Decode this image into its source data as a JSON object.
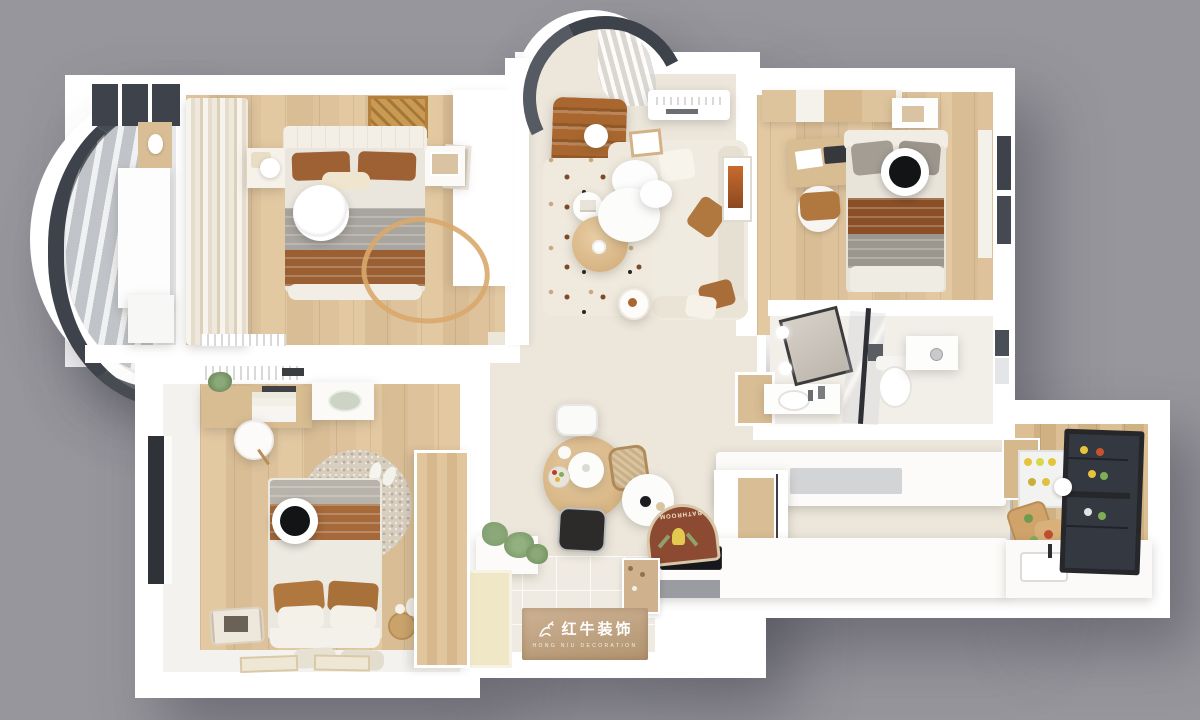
{
  "scene": {
    "description": "3D rendered top-down floor plan of a three-bedroom apartment on a gray backdrop",
    "rooms": [
      "curved-balcony-sunroom",
      "master-bedroom",
      "living-room",
      "bedroom-2",
      "bathroom",
      "hallway-dining",
      "kitchen",
      "bedroom-3",
      "entry-foyer"
    ]
  },
  "branding": {
    "logo_cn": "红牛装饰",
    "logo_en": "HONG NIU DECORATION"
  },
  "labels": {
    "bath_mat": "BATHROOM"
  },
  "colors": {
    "bg": "#97969c",
    "wall": "#ffffff",
    "cream": "#ece6db",
    "glass": "#3e434b",
    "leather": "#a9672f",
    "blanket-brown": "#9a5f33",
    "caramel": "#b0773f",
    "fabric-gray": "#a8a49e",
    "lamp-black": "#131416",
    "plant-green": "#7e9b6e",
    "mat-wood": "#c0a27c",
    "mat-brick": "#8d4a33"
  }
}
